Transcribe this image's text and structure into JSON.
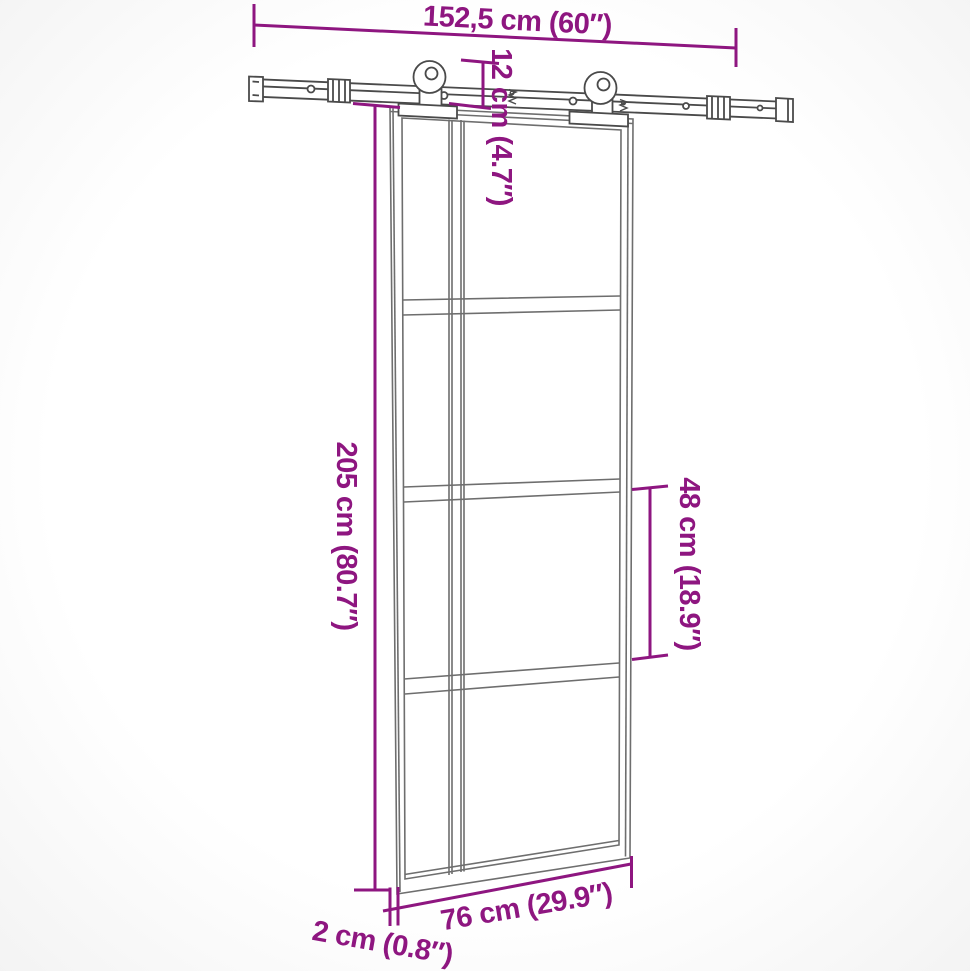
{
  "diagram": {
    "subject": "sliding-barn-door-with-track-hardware",
    "colors": {
      "dimension_annotation": "#8E1680",
      "hardware_line": "#4a4a4a",
      "door_line": "#6e6e6e",
      "background": "#ffffff"
    },
    "labels": {
      "track_length": "152,5 cm (60″)",
      "hanger_drop": "12 cm (4.7″)",
      "door_height": "205 cm (80.7″)",
      "panel_height": "48 cm (18.9″)",
      "door_width": "76 cm (29.9″)",
      "door_thickness": "2 cm (0.8″)"
    },
    "values": {
      "track_length_cm": 152.5,
      "track_length_in": 60,
      "hanger_drop_cm": 12,
      "hanger_drop_in": 4.7,
      "door_height_cm": 205,
      "door_height_in": 80.7,
      "panel_height_cm": 48,
      "panel_height_in": 18.9,
      "door_width_cm": 76,
      "door_width_in": 29.9,
      "door_thickness_cm": 2,
      "door_thickness_in": 0.8
    }
  }
}
